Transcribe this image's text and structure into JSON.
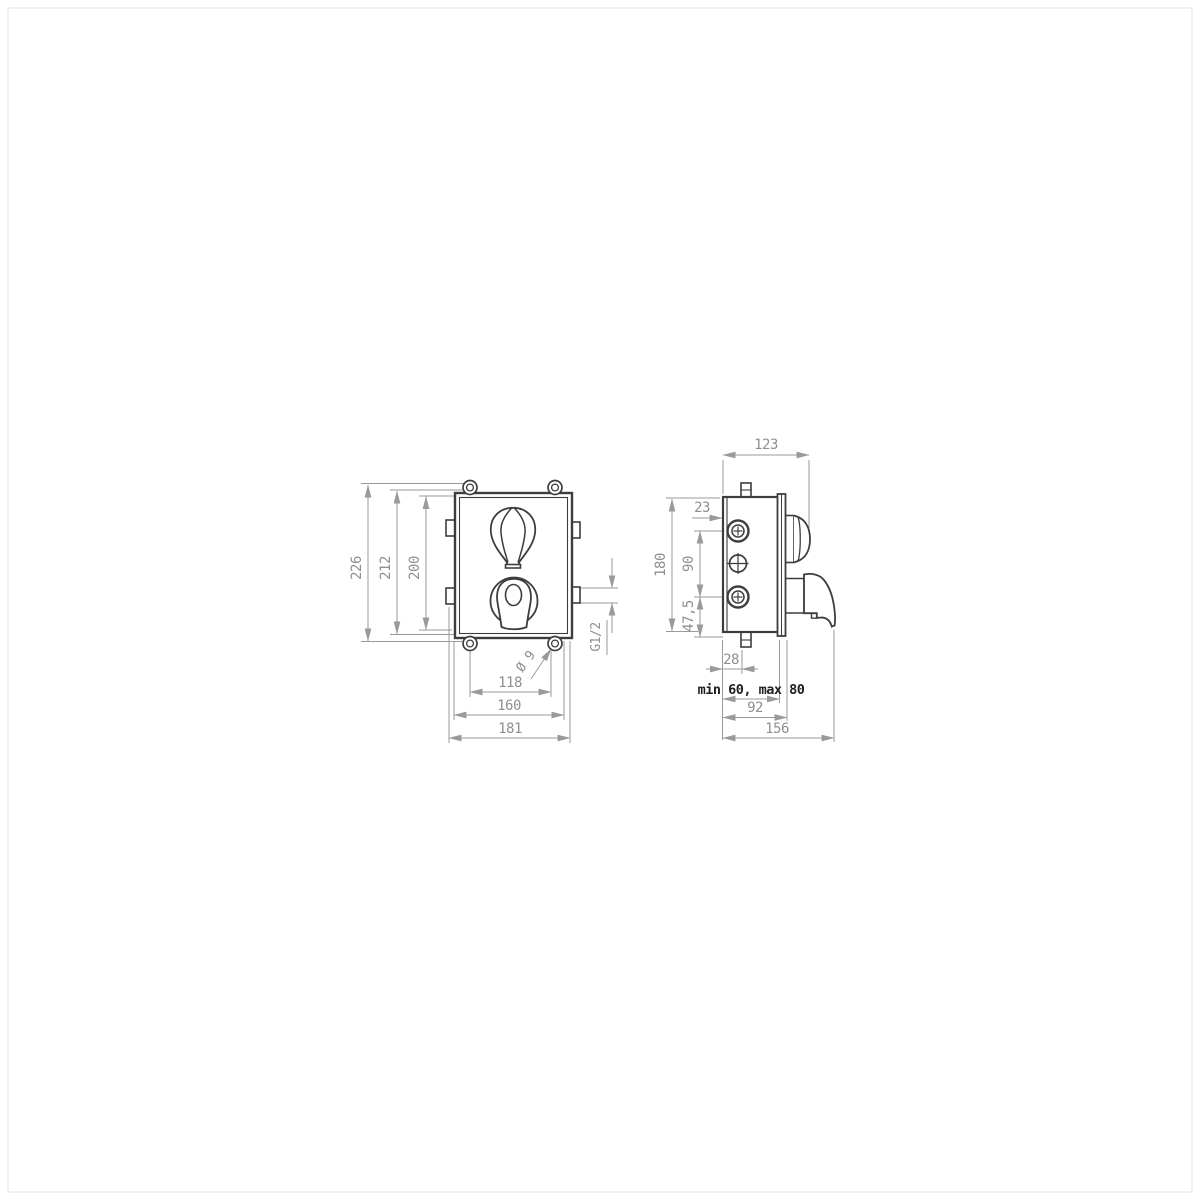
{
  "drawing": {
    "background_color": "#ffffff",
    "object_line_color": "#3d3d3d",
    "dimension_line_color": "#9a9a9a",
    "note_text_color": "#1f1f1f",
    "front_view": {
      "dim_overall_height": "226",
      "dim_body_height": "212",
      "dim_inner_height": "200",
      "dim_hole_spacing": "118",
      "dim_body_width": "160",
      "dim_overall_width": "181",
      "label_hole_diameter": "Ø 9",
      "label_thread": "G1/2"
    },
    "side_view": {
      "dim_depth_to_handle": "123",
      "dim_port_inset": "23",
      "dim_height": "180",
      "dim_port_spacing": "90",
      "dim_port_to_bottom": "47,5",
      "dim_stub_offset": "28",
      "note_install_depth": "min 60, max 80",
      "dim_depth_to_plate": "92",
      "dim_depth_to_lever": "156"
    }
  }
}
